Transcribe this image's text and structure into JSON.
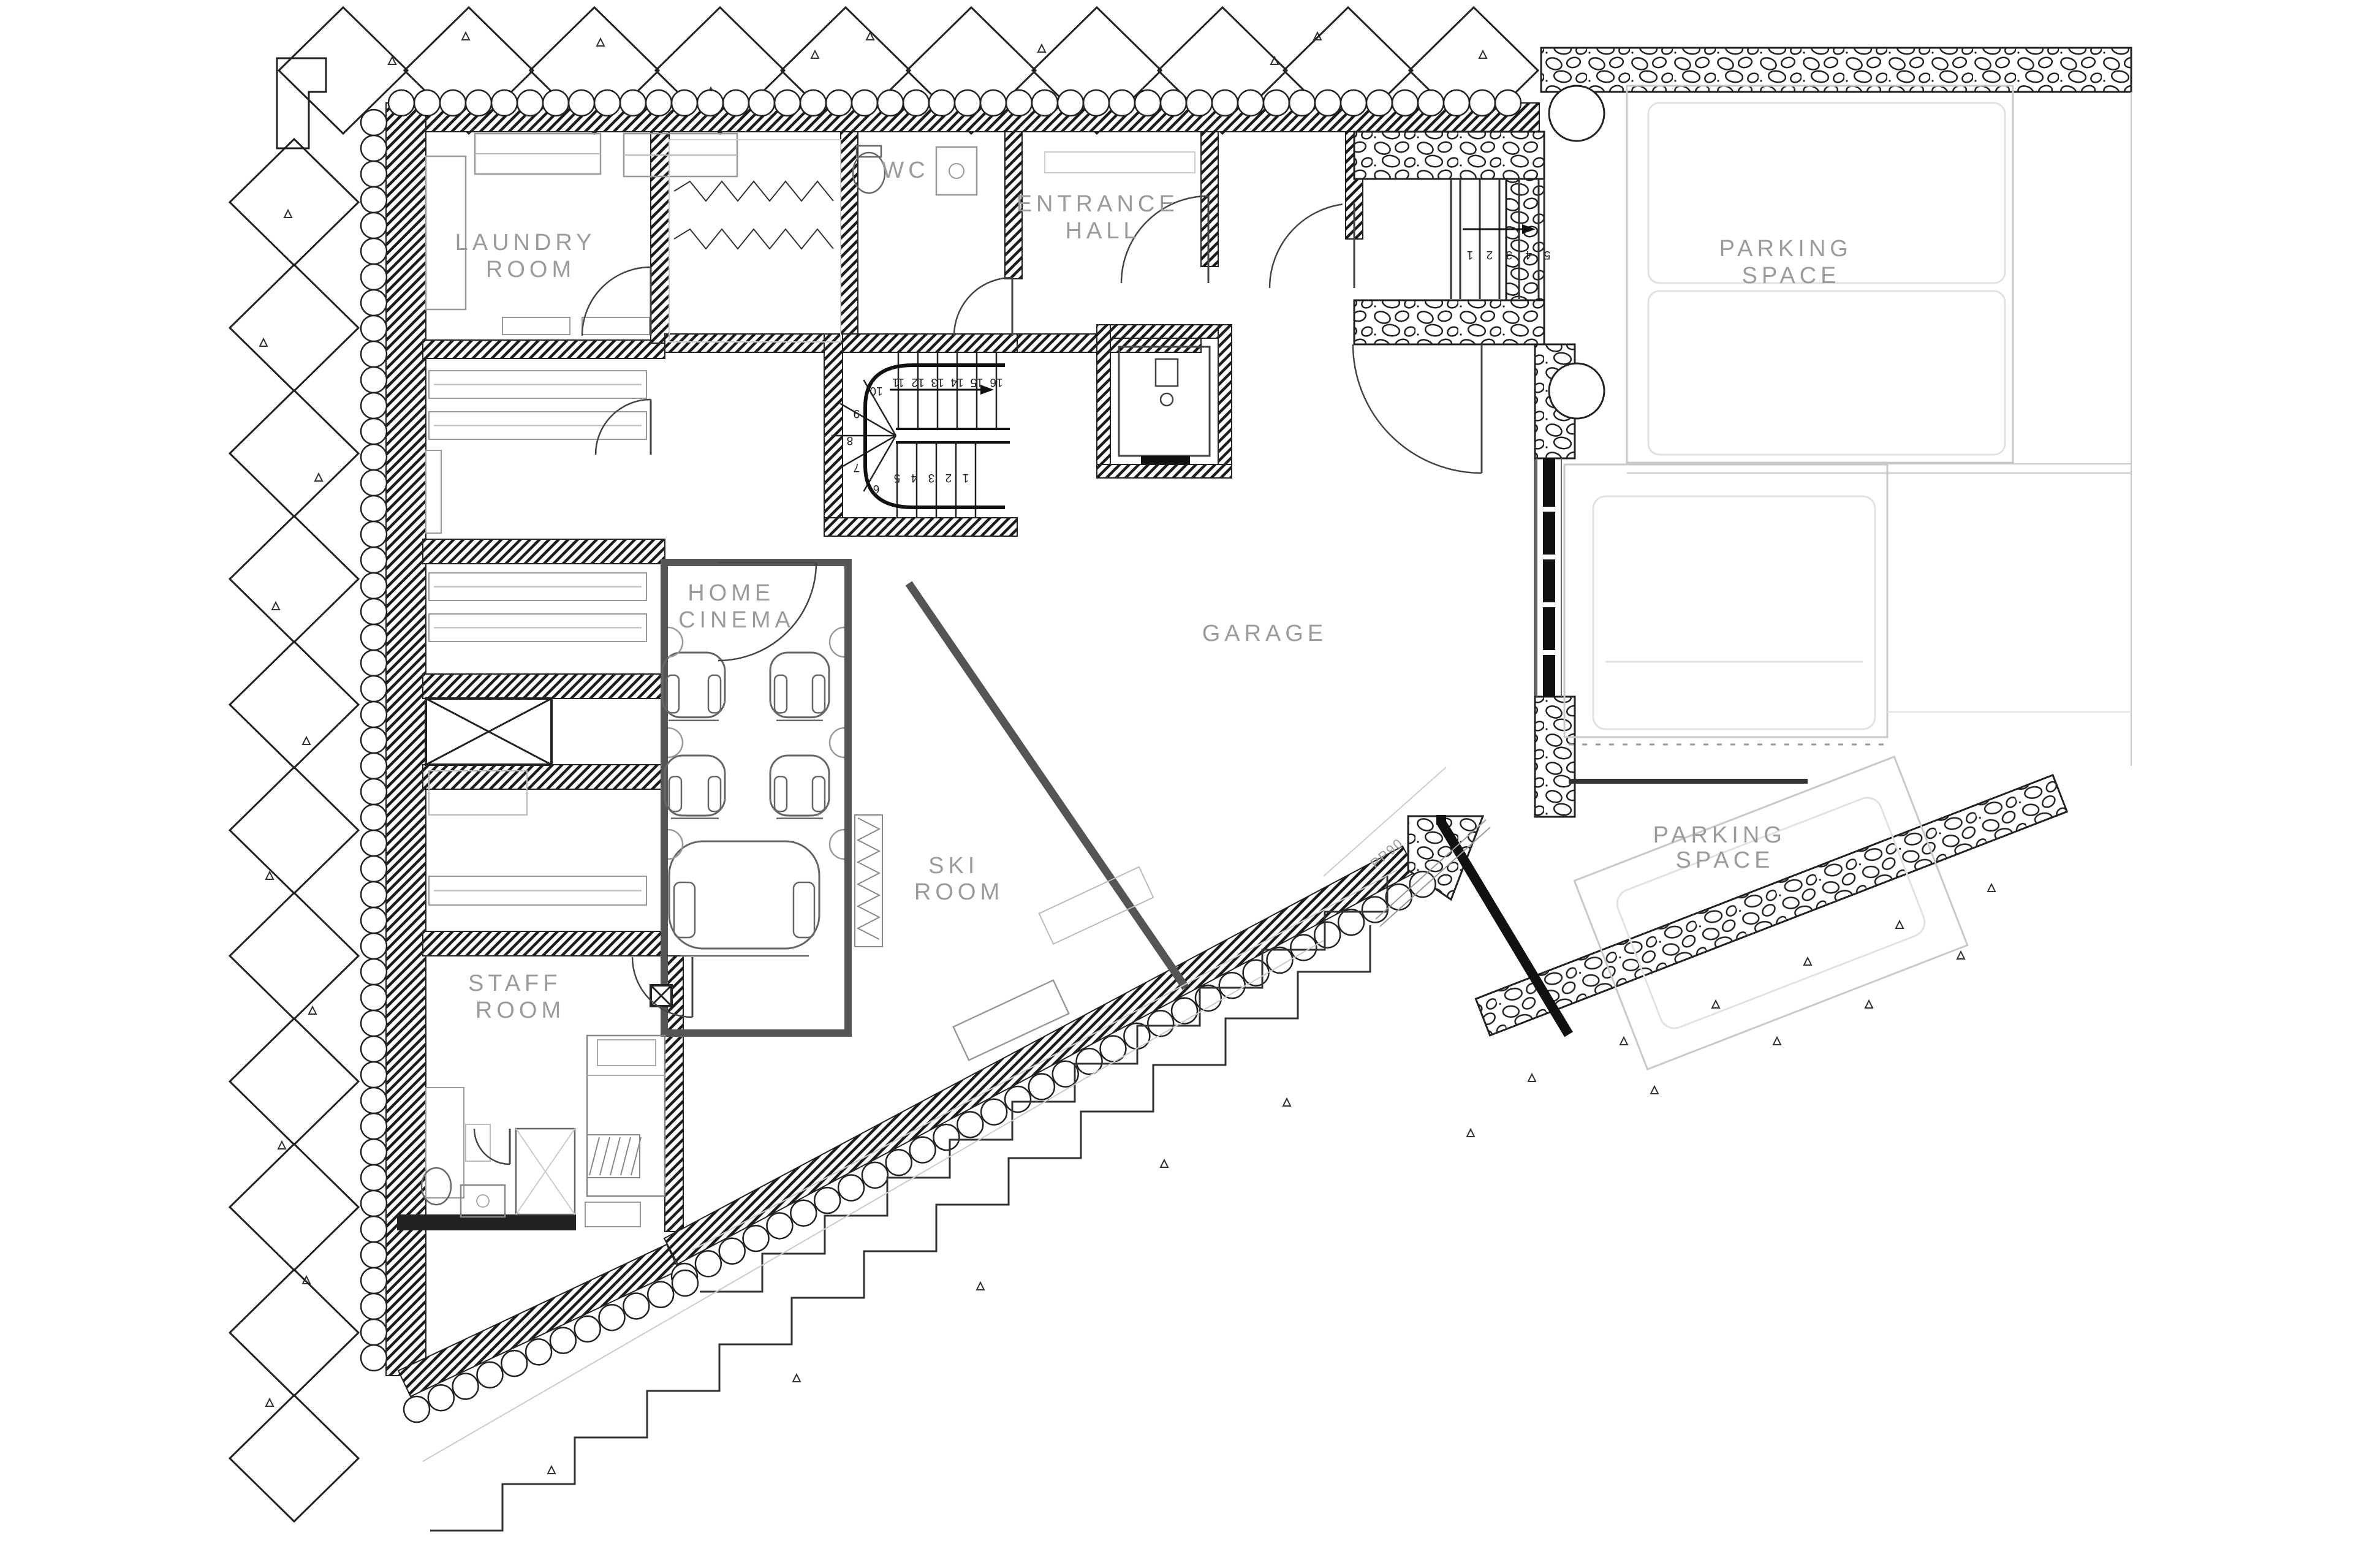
{
  "title": "Basement floor plan",
  "rooms": {
    "laundry": {
      "line1": "LAUNDRY",
      "line2": "ROOM"
    },
    "wc": {
      "label": "WC"
    },
    "entrance_hall": {
      "line1": "ENTRANCE",
      "line2": "HALL"
    },
    "parking_top": {
      "line1": "PARKING",
      "line2": "SPACE"
    },
    "home_cinema": {
      "line1": "HOME",
      "line2": "CINEMA"
    },
    "garage": {
      "label": "GARAGE"
    },
    "ski_room": {
      "line1": "SKI",
      "line2": "ROOM"
    },
    "staff_room": {
      "line1": "STAFF",
      "line2": "ROOM"
    },
    "parking_bottom": {
      "line1": "PARKING",
      "line2": "SPACE"
    }
  },
  "annotations": {
    "garage_door_code": "PP90"
  },
  "stair_main": {
    "numbers": [
      "1",
      "2",
      "3",
      "4",
      "5",
      "6",
      "7",
      "8",
      "9",
      "10",
      "11",
      "12",
      "13",
      "14",
      "15",
      "16"
    ]
  },
  "stair_entry": {
    "numbers": [
      "1",
      "2",
      "3",
      "4",
      "5"
    ]
  },
  "colors": {
    "label_text": "#9b9b9b",
    "wall_dark": "#1b1b1b",
    "wall_medium": "#555555",
    "line_light": "#c9c9c9",
    "line_faint": "#e2e2e2"
  }
}
